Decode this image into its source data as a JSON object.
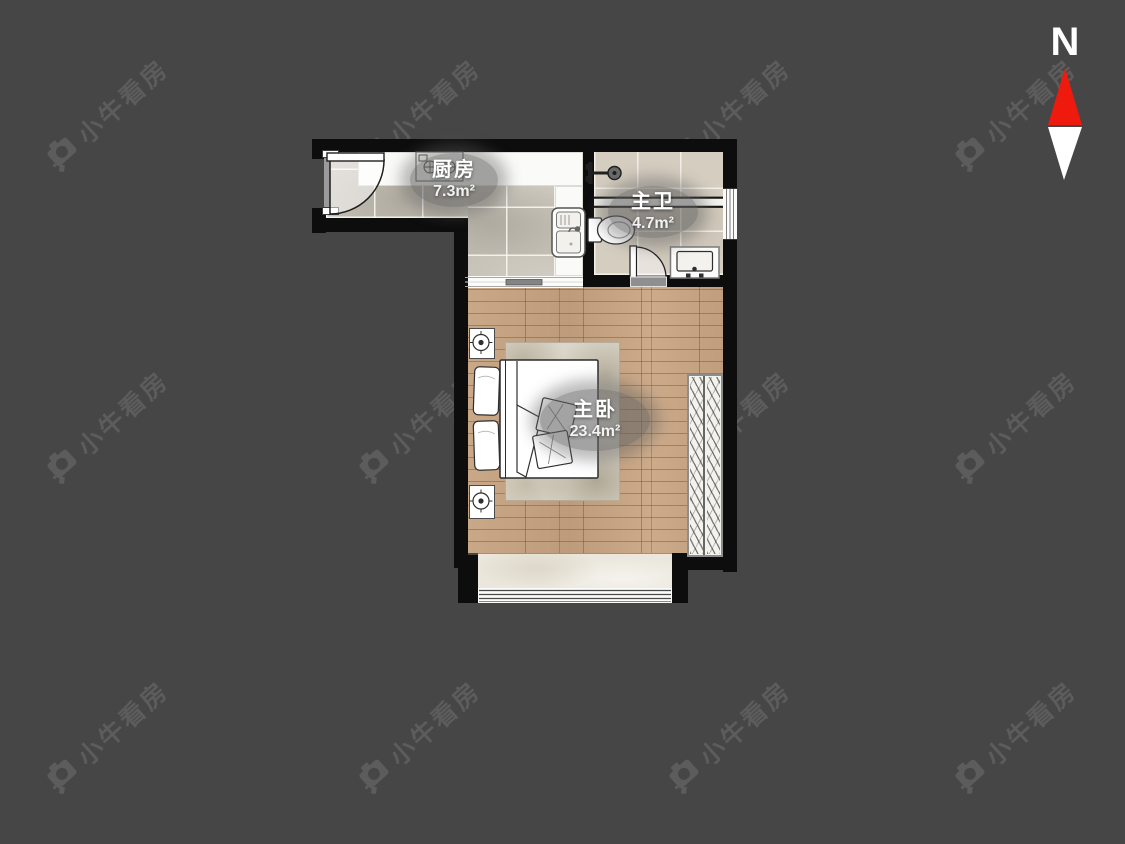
{
  "background_color": "#464646",
  "watermark": {
    "text": "小牛看房"
  },
  "compass": {
    "label": "N",
    "needle_up_color": "#ee1a0d",
    "needle_down_color": "#ffffff"
  },
  "rooms": [
    {
      "name": "厨房",
      "area": "7.3m²",
      "fixtures": [
        "entrance-door",
        "cooktop",
        "kitchen-sink",
        "sliding-opening-to-bedroom"
      ]
    },
    {
      "name": "主卫",
      "area": "4.7m²",
      "fixtures": [
        "shower",
        "shower-partition",
        "toilet",
        "vanity-sink",
        "door",
        "window"
      ]
    },
    {
      "name": "主卧",
      "area": "23.4m²",
      "fixtures": [
        "double-bed",
        "pillows",
        "cushions",
        "nightstand-with-lamp-x2",
        "rug",
        "wardrobe",
        "balcony",
        "balcony-window"
      ]
    }
  ],
  "palette": {
    "wall": "#0d0d0d",
    "wood_floor": "#c5a384",
    "kitchen_tile": "#c6c1b6",
    "bath_tile": "#d4cdc0",
    "label_bubble": "#616161"
  }
}
